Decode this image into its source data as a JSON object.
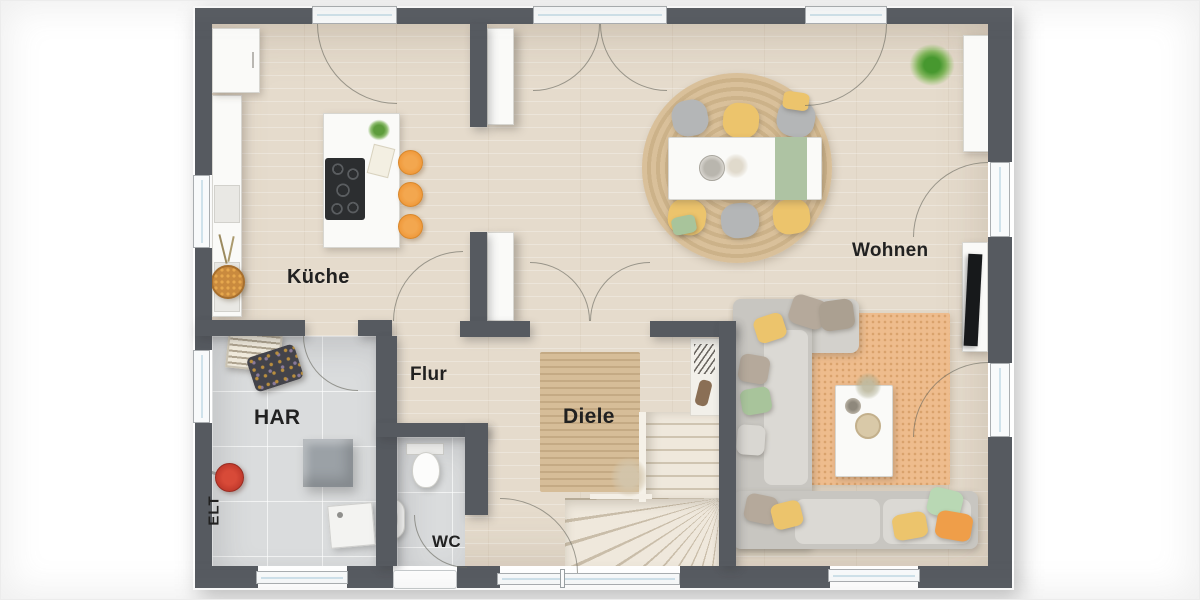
{
  "plan": {
    "type": "floor-plan",
    "language": "de",
    "rooms": [
      {
        "id": "kueche",
        "label": "Küche"
      },
      {
        "id": "wohnen",
        "label": "Wohnen"
      },
      {
        "id": "flur",
        "label": "Flur"
      },
      {
        "id": "diele",
        "label": "Diele"
      },
      {
        "id": "har",
        "label": "HAR"
      },
      {
        "id": "wc",
        "label": "WC"
      },
      {
        "id": "elt",
        "label": "ELT"
      }
    ],
    "colors": {
      "wall": "#565a60",
      "floor_wood": "#e5dbcc",
      "floor_tile": "#dadcdd",
      "rug_jute": "#d6bd98",
      "rug_orange": "#eebc8d",
      "stool_orange": "#f09a3c",
      "chair_yellow": "#ecc46c",
      "sofa_gray": "#d3d1cc",
      "accent_green": "#a8c49b",
      "stair": "#efe8dc",
      "glass": "#cfe2eb",
      "label": "#212121"
    }
  }
}
